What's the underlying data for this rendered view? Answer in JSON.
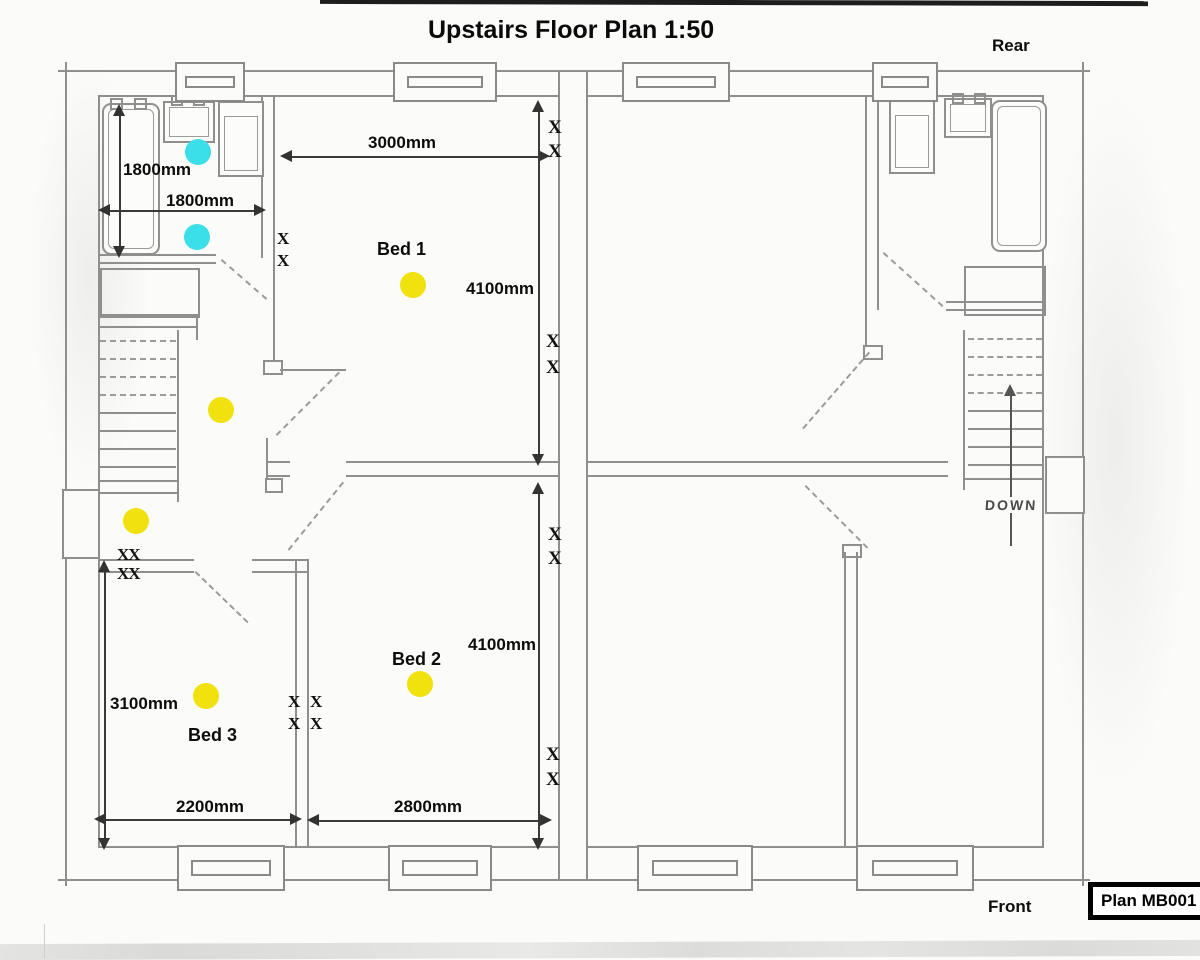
{
  "title": "Upstairs Floor Plan 1:50",
  "orientation_labels": {
    "rear": "Rear",
    "front": "Front"
  },
  "plan_reference": "Plan MB001",
  "stairs": {
    "down_label": "DOWN"
  },
  "rooms": {
    "bed1": "Bed 1",
    "bed2": "Bed 2",
    "bed3": "Bed 3"
  },
  "dimensions": {
    "bathroom_depth": "1800mm",
    "bathroom_width": "1800mm",
    "bed1_width": "3000mm",
    "bed1_depth": "4100mm",
    "bed3_depth": "3100mm",
    "bed3_width": "2200mm",
    "bed2_width": "2800mm",
    "bed2_depth": "4100mm"
  },
  "marks": {
    "socket_single": "X",
    "socket_double": "XX"
  },
  "symbol_colors": {
    "ceiling_light_yellow": "#F1E20E",
    "wall_light_cyan": "#3ADFEA",
    "pencil_gray": "#8F8F8D",
    "dimension_ink": "#333333"
  }
}
